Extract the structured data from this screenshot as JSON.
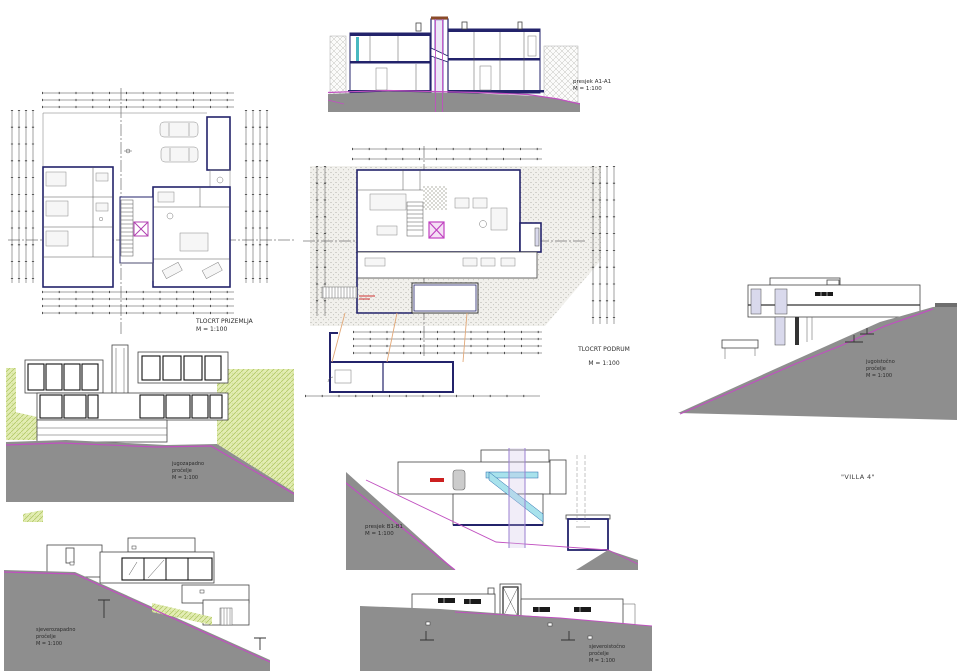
{
  "sheet": {
    "project_title": "\"VILLA 4\""
  },
  "drawings": {
    "section_a1": {
      "title": "presjek A1-A1",
      "scale": "M = 1:100"
    },
    "plan_ground": {
      "title": "TLOCRT PRIZEMLJA",
      "scale": "M = 1:100"
    },
    "plan_basement": {
      "title": "TLOCRT PODRUM",
      "scale": "M = 1:100"
    },
    "section_b1": {
      "title": "presjek B1-B1",
      "scale": "M = 1:100"
    },
    "elev_right": {
      "line1": "jugoistočno",
      "line2": "pročelje",
      "scale": "M = 1:100"
    },
    "elev_left_mid": {
      "line1": "jugozapadno",
      "line2": "pročelje",
      "scale": "M = 1:100"
    },
    "elev_bottom_left": {
      "line1": "sjeverozapadno",
      "line2": "pročelje",
      "scale": "M = 1:100"
    },
    "elev_bottom_mid": {
      "line1": "sjeveroistočno",
      "line2": "pročelje",
      "scale": "M = 1:100"
    }
  },
  "colors": {
    "wall_navy": "#23236b",
    "terrain_magenta": "#c050c0",
    "ground_gray": "#8e8e8e",
    "hill_green": "#e3edb4",
    "stair_cyan": "#a8e2ec",
    "shaft_purple": "#9a7fd0",
    "guide_orange": "#e2a878",
    "annotation_red": "#cc2020",
    "window_lavender": "#d9d9ec",
    "window_teal": "#49b8c0",
    "elevator_cap_brown": "#8a4a28"
  }
}
